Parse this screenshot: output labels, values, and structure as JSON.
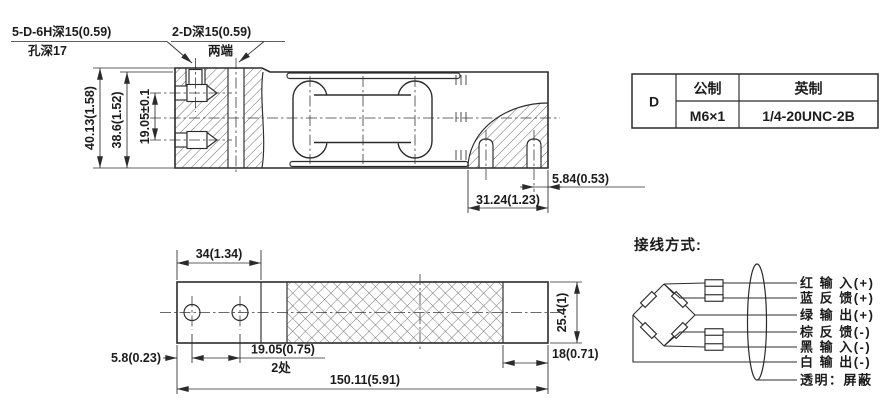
{
  "side_view": {
    "callout_holes_line1": "5-D-6H深15(0.59)",
    "callout_holes_line2": "孔深17",
    "callout_ends_line1": "2-D深15(0.59)",
    "callout_ends_line2": "两端",
    "dim_total_height": "40.13(1.58)",
    "dim_body_height": "38.6(1.52)",
    "dim_screw_spacing": "19.05±0.1",
    "dim_hole_to_edge": "5.84(0.53)",
    "dim_hole_offset": "31.24(1.23)"
  },
  "top_view": {
    "dim_block_length": "34(1.34)",
    "dim_edge_to_hole": "5.8(0.23)",
    "dim_hole_spacing": "19.05(0.75)",
    "dim_hole_spacing_note": "2处",
    "dim_total_length": "150.11(5.91)",
    "dim_end_length": "18(0.71)",
    "dim_width": "25.4(1)"
  },
  "thread_table": {
    "row_label": "D",
    "col_metric": "公制",
    "col_imperial": "英制",
    "metric_value": "M6×1",
    "imperial_value": "1/4-20UNC-2B"
  },
  "wiring": {
    "title": "接线方式:",
    "wires": [
      {
        "label": "红 输 入(+)"
      },
      {
        "label": "蓝 反 馈(+)"
      },
      {
        "label": "绿 输 出(+)"
      },
      {
        "label": "棕 反 馈(-)"
      },
      {
        "label": "黑 输 入(-)"
      },
      {
        "label": "白 输 出(-)"
      },
      {
        "label": "透明：屏蔽"
      }
    ]
  },
  "colors": {
    "line": "#2b2b2b",
    "background": "#ffffff"
  }
}
